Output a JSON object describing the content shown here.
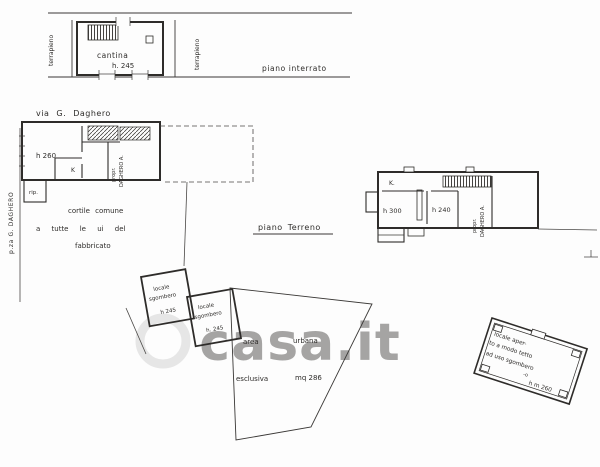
{
  "plan": {
    "watermark": "casa.it",
    "basement": {
      "title": "piano interrato",
      "room": "cantina",
      "room_height": "h. 245",
      "left_margin": "terrapieno",
      "right_margin": "terrapieno"
    },
    "streets": {
      "via": "via G. Daghero",
      "piazza": "p.za G. DAGHERO"
    },
    "ground_floor": {
      "title": "piano Terreno",
      "left_unit": {
        "room_height": "h 260",
        "kitchen": "K",
        "storage": "rip.",
        "owner_line1": "propr.",
        "owner_line2": "DAGHERO A."
      },
      "right_unit": {
        "kitchen": "K.",
        "room1_height": "h 300",
        "room2_height": "h 240",
        "owner_line1": "propr.",
        "owner_line2": "DAGHERO A."
      },
      "courtyard": {
        "line1": "cortile comune",
        "line2": "a tutte le ui del",
        "line3": "fabbricato"
      }
    },
    "annexes": {
      "storage1": {
        "line1": "locale",
        "line2": "sgombero",
        "line3": "h 245"
      },
      "storage2": {
        "line1": "locale",
        "line2": "sgombero",
        "line3": "h. 245"
      },
      "urban_area": {
        "word1": "area",
        "word2": "urbana",
        "word3": "esclusiva",
        "word4": "mq 286"
      },
      "open_shed": {
        "line1": "locale aper-",
        "line2": "to a modo tetto",
        "line3": "ad uso sgombero",
        "line4": "-o",
        "height": "h m 260"
      }
    }
  }
}
